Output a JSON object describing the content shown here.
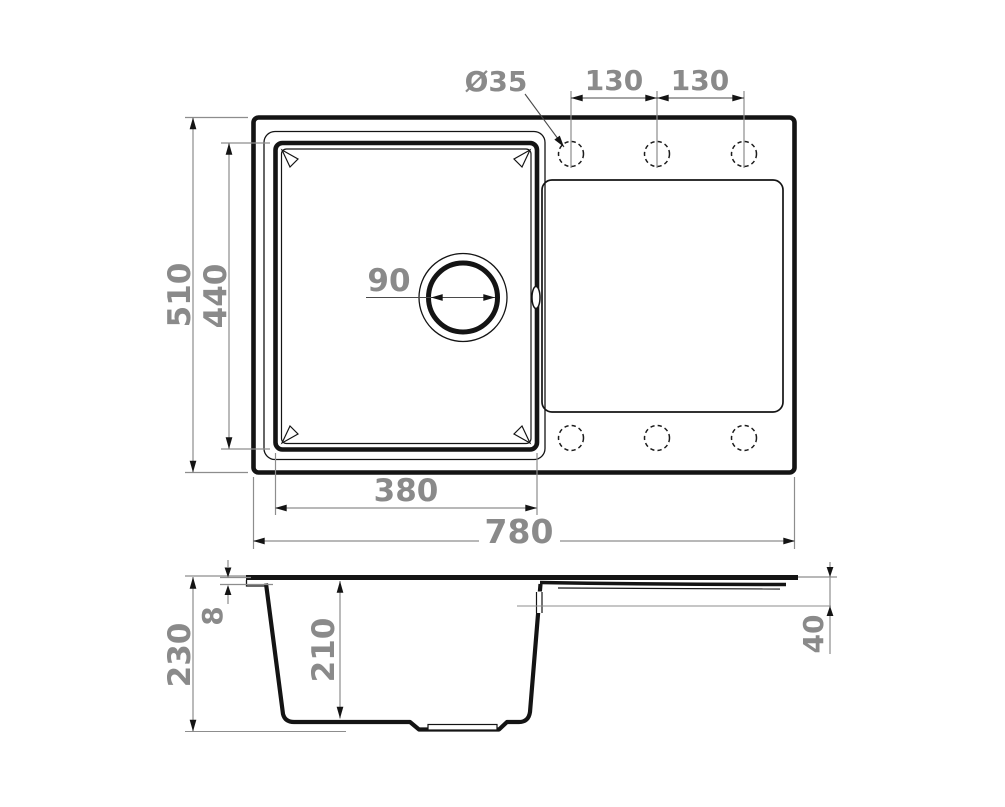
{
  "figure": {
    "type": "technical-drawing-sink",
    "colors": {
      "line": "#141414",
      "dim_line": "#8d8d8d",
      "dim_text": "#8a8a8a",
      "background": "#ffffff"
    },
    "top_view": {
      "overall_width_label": "780",
      "overall_depth_label": "510",
      "bowl_width_label": "380",
      "bowl_depth_label": "440",
      "drain_diameter_label": "90",
      "faucet_hole_diameter_label": "Ø35",
      "hole_spacing_left_label": "130",
      "hole_spacing_right_label": "130"
    },
    "side_view": {
      "overall_height_label": "230",
      "rim_thickness_label": "8",
      "bowl_depth_label": "210",
      "drainboard_end_depth_label": "40"
    }
  }
}
